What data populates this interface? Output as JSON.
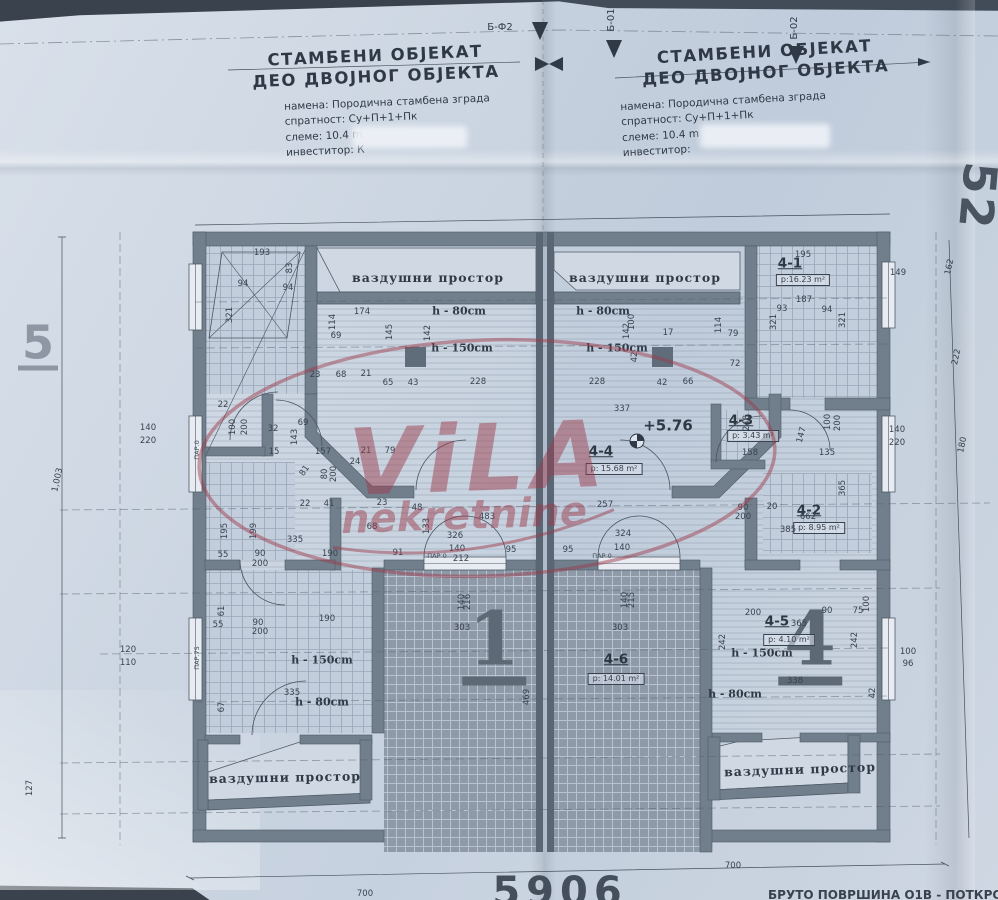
{
  "photo_subject": "architectural attic floor plan of a semi-detached residential building",
  "colors": {
    "paper": "#ccd6e2",
    "wall": "#717e8c",
    "ink": "#39434f",
    "watermark": "#9c3a4a",
    "background": "#39424d"
  },
  "title_left": {
    "line1": "СТАМБЕНИ ОБЈЕКАТ",
    "line2": "ДЕО ДВОЈНОГ ОБЈЕКТА",
    "namena": "намена: Породична стамбена зграда",
    "spratnost": "спратност: Су+П+1+Пк",
    "sleme": "слеме: 10.4 m",
    "investitor": "инвеститор: К"
  },
  "title_right": {
    "line1": "СТАМБЕНИ ОБЈЕКАТ",
    "line2": "ДЕО ДВОЈНОГ ОБЈЕКТА",
    "namena": "намена: Породична стамбена зграда",
    "spratnost": "спратност: Су+П+1+Пк",
    "sleme": "слеме: 10.4 m",
    "investitor": "инвеститор:"
  },
  "watermark": {
    "line1": "ViLA",
    "line2": "nekretnine"
  },
  "bottom_caption": "БРУТО ПОВРШИНА О1В  - ПОТКРОВЉА",
  "rooms": [
    {
      "id": "4-1",
      "area": "р:16.23 m²"
    },
    {
      "id": "4-2",
      "area": "р: 8.95 m²"
    },
    {
      "id": "4-3",
      "area": "р: 3.43 m²"
    },
    {
      "id": "4-4",
      "area": "р: 15.68 m²"
    },
    {
      "id": "4-5",
      "area": "р: 4.10 m²"
    },
    {
      "id": "4-6",
      "area": "р: 14.01 m²"
    }
  ],
  "labels": [
    [
      "Б-Ф2",
      500,
      28,
      0,
      "ax"
    ],
    [
      "Б-01",
      612,
      20,
      -90,
      "ax"
    ],
    [
      "Б-02",
      795,
      28,
      -90,
      "ax"
    ],
    [
      "5",
      38,
      345,
      0,
      "big5"
    ],
    [
      "52",
      978,
      196,
      95,
      "big52"
    ],
    [
      "1",
      494,
      644,
      0,
      "bignum"
    ],
    [
      "4",
      810,
      644,
      0,
      "bignum"
    ],
    [
      "5906",
      560,
      892,
      0,
      "cutnum"
    ],
    [
      "+5.76",
      668,
      426,
      0,
      "elev"
    ],
    [
      "4-4",
      601,
      452,
      0,
      "rid"
    ],
    [
      "р: 15.68 m²",
      614,
      469,
      0,
      "abox"
    ],
    [
      "4-1",
      790,
      264,
      0,
      "rid"
    ],
    [
      "р:16.23 m²",
      803,
      280,
      0,
      "abox"
    ],
    [
      "4-3",
      741,
      421,
      0,
      "rid"
    ],
    [
      "р: 3.43 m²",
      753,
      436,
      0,
      "abox"
    ],
    [
      "4-2",
      809,
      511,
      0,
      "rid"
    ],
    [
      "р: 8.95 m²",
      819,
      528,
      0,
      "abox"
    ],
    [
      "4-5",
      777,
      622,
      0,
      "rid"
    ],
    [
      "365",
      799,
      624,
      0,
      "dim"
    ],
    [
      "р: 4.10 m²",
      789,
      640,
      0,
      "abox"
    ],
    [
      "4-6",
      616,
      660,
      0,
      "rid"
    ],
    [
      "р: 14.01 m²",
      616,
      679,
      0,
      "abox"
    ],
    [
      "ваздушни простор",
      428,
      278,
      0,
      "air"
    ],
    [
      "ваздушни простор",
      645,
      278,
      0,
      "air"
    ],
    [
      "ваздушни простор",
      285,
      778,
      -1,
      "air"
    ],
    [
      "ваздушни простор",
      800,
      770,
      -2,
      "air"
    ],
    [
      "h - 80cm",
      459,
      311,
      0,
      "hl"
    ],
    [
      "h - 150cm",
      462,
      348,
      0,
      "hl"
    ],
    [
      "h - 80cm",
      603,
      311,
      0,
      "hl"
    ],
    [
      "h - 150cm",
      617,
      348,
      0,
      "hl"
    ],
    [
      "h - 150cm",
      322,
      660,
      0,
      "hl"
    ],
    [
      "h - 80cm",
      322,
      702,
      0,
      "hl"
    ],
    [
      "h - 150cm",
      762,
      653,
      0,
      "hl"
    ],
    [
      "h - 80cm",
      735,
      694,
      0,
      "hl"
    ],
    [
      "ПАР.0",
      197,
      450,
      -90,
      "win"
    ],
    [
      "ПАР.75",
      197,
      658,
      -90,
      "win"
    ],
    [
      "ПАР 0",
      437,
      556,
      0,
      "win"
    ],
    [
      "ПАР 0",
      602,
      556,
      0,
      "win"
    ],
    [
      "193",
      262,
      253
    ],
    [
      "94",
      243,
      284
    ],
    [
      "94",
      288,
      288
    ],
    [
      "321",
      230,
      315,
      -90
    ],
    [
      "83",
      290,
      268,
      -90
    ],
    [
      "174",
      362,
      312
    ],
    [
      "114",
      333,
      322,
      -90
    ],
    [
      "69",
      336,
      336
    ],
    [
      "145",
      390,
      332,
      -90
    ],
    [
      "142",
      428,
      333,
      -90
    ],
    [
      "23",
      315,
      375
    ],
    [
      "68",
      341,
      375
    ],
    [
      "21",
      366,
      374
    ],
    [
      "65",
      388,
      383
    ],
    [
      "43",
      413,
      383
    ],
    [
      "228",
      478,
      382
    ],
    [
      "228",
      597,
      382
    ],
    [
      "42",
      662,
      383
    ],
    [
      "66",
      688,
      382
    ],
    [
      "17",
      668,
      333
    ],
    [
      "79",
      733,
      334
    ],
    [
      "114",
      719,
      325,
      -90
    ],
    [
      "100",
      632,
      322,
      -90
    ],
    [
      "142",
      627,
      331,
      -90
    ],
    [
      "42",
      635,
      357,
      -90
    ],
    [
      "72",
      735,
      364
    ],
    [
      "93",
      782,
      309
    ],
    [
      "94",
      827,
      310
    ],
    [
      "321",
      774,
      322,
      -90
    ],
    [
      "321",
      843,
      320,
      -90
    ],
    [
      "195",
      803,
      255
    ],
    [
      "187",
      804,
      300
    ],
    [
      "149",
      898,
      273
    ],
    [
      "162",
      950,
      267,
      -78
    ],
    [
      "222",
      957,
      357,
      -78
    ],
    [
      "180",
      963,
      445,
      -78
    ],
    [
      "140",
      897,
      430
    ],
    [
      "220",
      897,
      443
    ],
    [
      "140",
      148,
      428
    ],
    [
      "220",
      148,
      441
    ],
    [
      "120",
      128,
      650
    ],
    [
      "110",
      128,
      663
    ],
    [
      "1,003",
      58,
      480,
      -78
    ],
    [
      "127",
      30,
      788,
      -90
    ],
    [
      "22",
      223,
      405
    ],
    [
      "100",
      233,
      427,
      -90
    ],
    [
      "200",
      245,
      427,
      -90
    ],
    [
      "32",
      273,
      429
    ],
    [
      "69",
      303,
      423
    ],
    [
      "143",
      295,
      437,
      -90
    ],
    [
      "15",
      274,
      452
    ],
    [
      "157",
      323,
      452
    ],
    [
      "21",
      366,
      451
    ],
    [
      "79",
      390,
      451
    ],
    [
      "24",
      355,
      462
    ],
    [
      "81",
      305,
      471,
      -55
    ],
    [
      "80",
      325,
      474,
      -90
    ],
    [
      "200",
      334,
      474,
      -90
    ],
    [
      "22",
      305,
      504
    ],
    [
      "41",
      329,
      504
    ],
    [
      "23",
      382,
      503
    ],
    [
      "48",
      417,
      508
    ],
    [
      "68",
      372,
      527
    ],
    [
      "195",
      225,
      531,
      -90
    ],
    [
      "199",
      254,
      531,
      -90
    ],
    [
      "335",
      295,
      540
    ],
    [
      "190",
      330,
      554
    ],
    [
      "91",
      398,
      553
    ],
    [
      "55",
      223,
      555
    ],
    [
      "90",
      260,
      554
    ],
    [
      "200",
      260,
      564
    ],
    [
      "61",
      222,
      611,
      -90
    ],
    [
      "55",
      218,
      625
    ],
    [
      "90",
      258,
      623
    ],
    [
      "200",
      260,
      632
    ],
    [
      "190",
      327,
      619
    ],
    [
      "335",
      292,
      693
    ],
    [
      "67",
      222,
      707,
      -90
    ],
    [
      "133",
      427,
      526,
      -90
    ],
    [
      "326",
      455,
      536
    ],
    [
      "140",
      457,
      549
    ],
    [
      "212",
      461,
      559
    ],
    [
      "95",
      511,
      550
    ],
    [
      "95",
      568,
      550
    ],
    [
      "324",
      623,
      534
    ],
    [
      "140",
      622,
      548
    ],
    [
      "140",
      462,
      602,
      -90
    ],
    [
      "216",
      468,
      602,
      -90
    ],
    [
      "140",
      625,
      600,
      -90
    ],
    [
      "215",
      632,
      600,
      -90
    ],
    [
      "303",
      462,
      628
    ],
    [
      "303",
      620,
      628
    ],
    [
      "469",
      527,
      697,
      -90
    ],
    [
      "337",
      622,
      409
    ],
    [
      "257",
      605,
      505
    ],
    [
      "662",
      808,
      517
    ],
    [
      "483",
      487,
      517
    ],
    [
      "248",
      747,
      423,
      -90
    ],
    [
      "365",
      843,
      488,
      -90
    ],
    [
      "385",
      788,
      530
    ],
    [
      "90",
      743,
      508
    ],
    [
      "20",
      772,
      507
    ],
    [
      "200",
      743,
      517
    ],
    [
      "158",
      750,
      453
    ],
    [
      "135",
      827,
      453
    ],
    [
      "100",
      828,
      422,
      -90
    ],
    [
      "200",
      838,
      423,
      -90
    ],
    [
      "147",
      802,
      435,
      -75
    ],
    [
      "200",
      753,
      613
    ],
    [
      "90",
      827,
      611
    ],
    [
      "75",
      858,
      611
    ],
    [
      "100",
      867,
      604,
      -90
    ],
    [
      "242",
      723,
      642,
      -90
    ],
    [
      "242",
      855,
      640,
      -90
    ],
    [
      "338",
      795,
      681
    ],
    [
      "100",
      908,
      652
    ],
    [
      "96",
      908,
      664
    ],
    [
      "42",
      873,
      693,
      -90
    ],
    [
      "700",
      733,
      866
    ],
    [
      "700",
      365,
      894
    ]
  ]
}
